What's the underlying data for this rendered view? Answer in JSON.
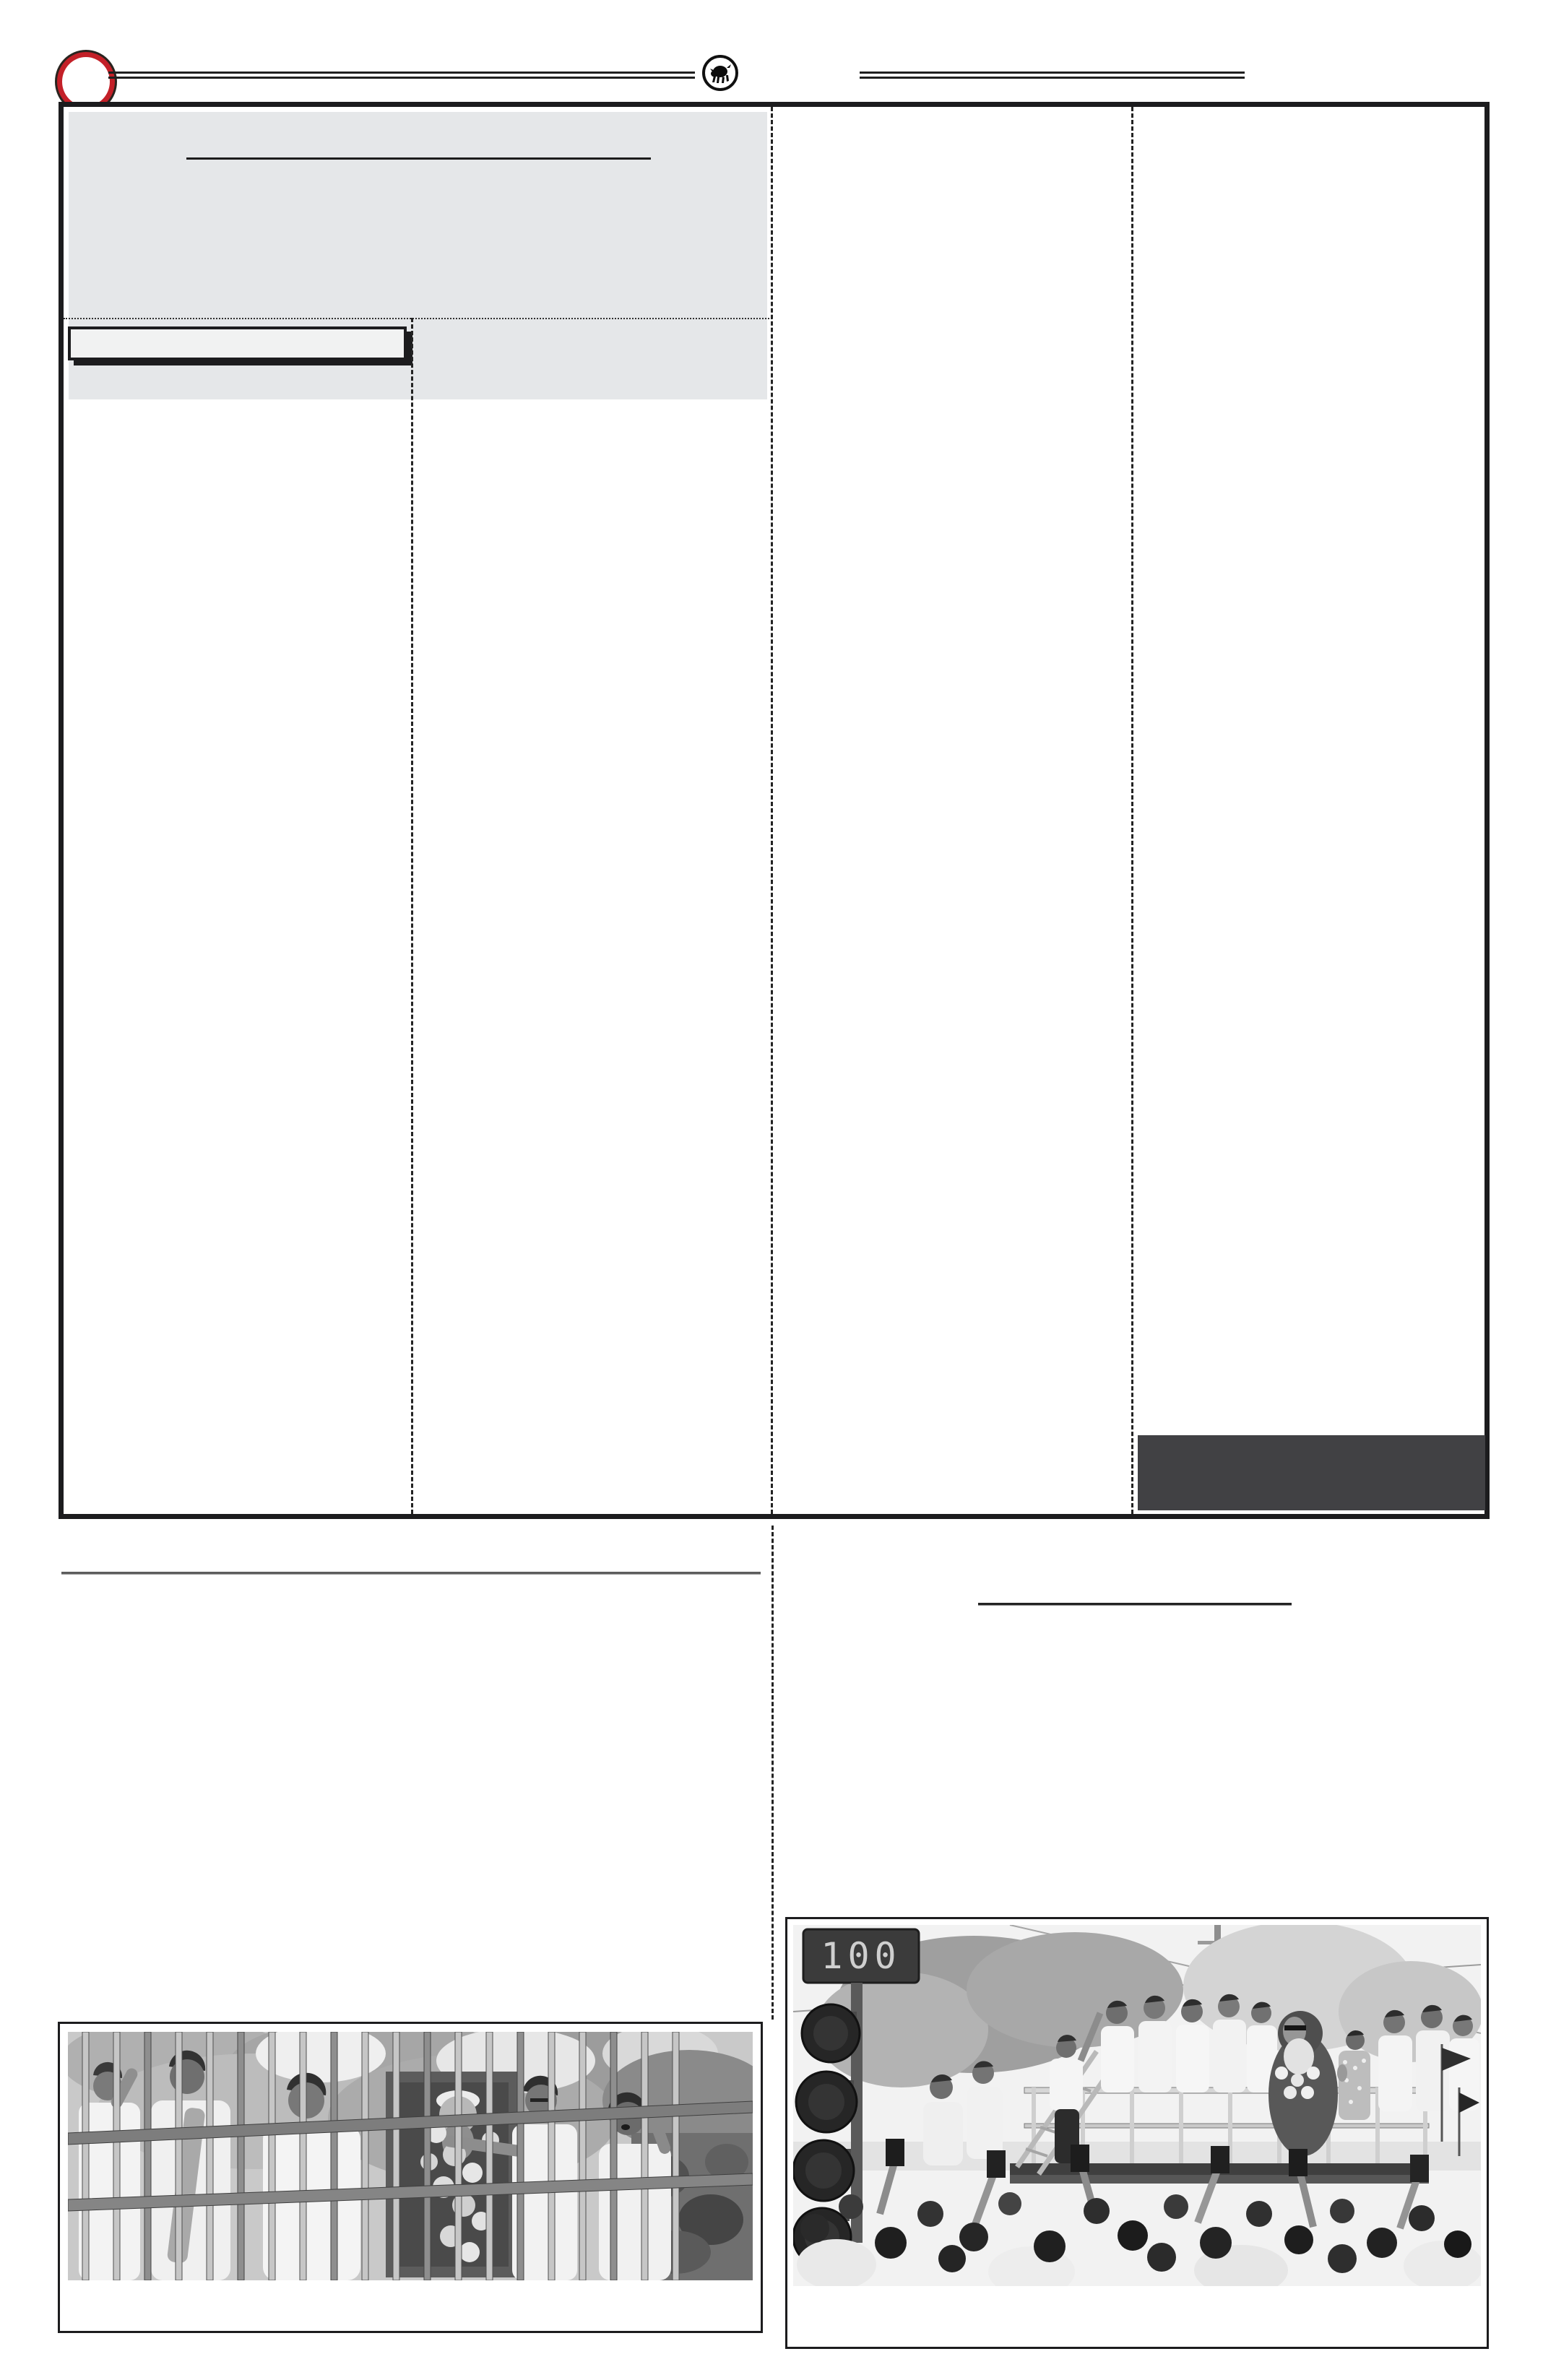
{
  "page": {
    "kind": "newspaper e-paper page layout (article text not rendered)",
    "background": "#ffffff"
  },
  "masthead": {
    "left_ornament": "red circle ornament",
    "emblem": "charging bull emblem in circle",
    "rules": "double horizontal rules left and right of emblem"
  },
  "colors": {
    "accent_red": "#c32028",
    "ink": "#1c1c1e",
    "header_panel_gray": "#e5e7e9",
    "promo_panel_gray": "#f1f2f2",
    "dark_panel_gray": "#414144",
    "divider_dash": "#232323"
  },
  "main_board": {
    "columns": 4,
    "header_panel": {
      "headline_rule": "black underline rule inside gray headline panel"
    },
    "promo_panel": {
      "style": "bordered box with hard drop shadow"
    },
    "dark_panel": {
      "style": "solid dark gray block, bottom right"
    }
  },
  "photos": {
    "left": {
      "description": "B/W news photo: men in white shirts pay floral tribute to a garlanded statue enclosed in a metal bar cage; one reaches through the bars, another gestures while speaking; trees behind, stone wall at right.",
      "caption": ""
    },
    "right": {
      "description": "B/W news photo: party workers in white on a railed trailer with a large garlanded statue of a bearded leader; woman greets with folded hands; crowd below raises hands and phones; traffic signal with LED countdown at left; flags at right.",
      "traffic_countdown": "100",
      "caption": ""
    }
  }
}
